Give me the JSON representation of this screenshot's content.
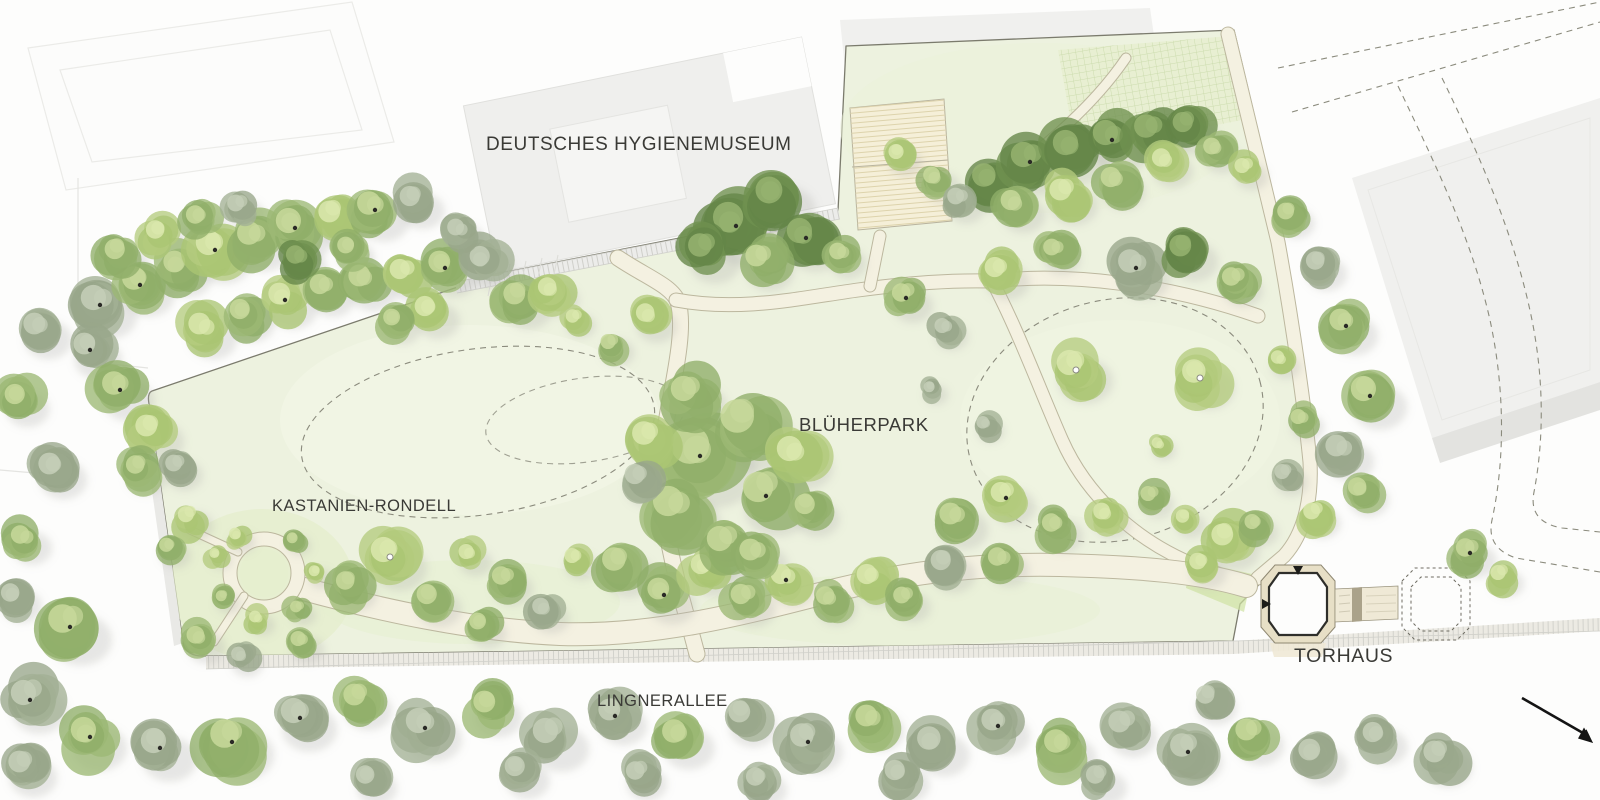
{
  "map": {
    "labels": {
      "museum": "DEUTSCHES HYGIENEMUSEUM",
      "park": "BLÜHERPARK",
      "rondell": "KASTANIEN-RONDELL",
      "torhaus": "TORHAUS",
      "allee": "LINGNERALLEE"
    },
    "icons": {
      "direction_arrow": "arrow-down-right"
    },
    "colors": {
      "background": "#fdfdfc",
      "lawn": "#edf2df",
      "lawn_bright": "#e2ecc8",
      "path": "#f4f1e1",
      "path_edge": "#bcb79e",
      "building": "#f0f0ee",
      "boundary_line": "#7b7b6d",
      "dashed_line": "#8b8b7d",
      "label_text": "#3a3a36",
      "plaza": "#f5efd8",
      "torhaus_band": "#e7dfc6",
      "tree_mid": "#9cb874",
      "tree_bright": "#b5cc7f",
      "tree_gray": "#a3b195",
      "tree_dark": "#6f9150",
      "arrow": "#141414"
    }
  }
}
